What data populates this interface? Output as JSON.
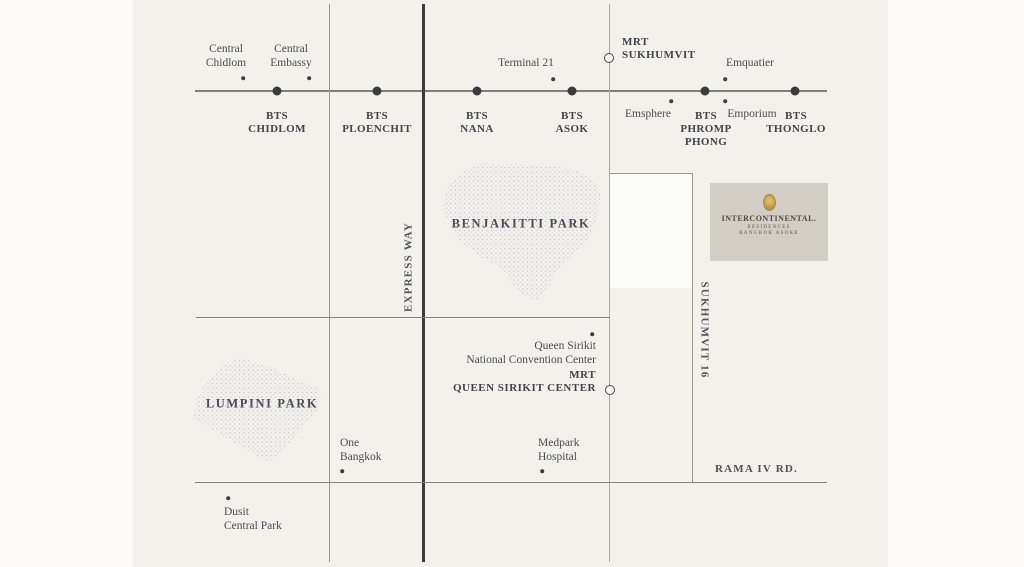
{
  "map": {
    "bts_stations": {
      "chidlom": {
        "line1": "BTS",
        "line2": "CHIDLOM"
      },
      "ploenchit": {
        "line1": "BTS",
        "line2": "PLOENCHIT"
      },
      "nana": {
        "line1": "BTS",
        "line2": "NANA"
      },
      "asok": {
        "line1": "BTS",
        "line2": "ASOK"
      },
      "phromphong": {
        "line1": "BTS",
        "line2": "PHROMP",
        "line3": "PHONG"
      },
      "thonglo": {
        "line1": "BTS",
        "line2": "THONGLO"
      }
    },
    "mrt_stations": {
      "sukhumvit": {
        "line1": "MRT",
        "line2": "SUKHUMVIT"
      },
      "queen_sirikit": {
        "line1": "MRT",
        "line2": "QUEEN SIRIKIT CENTER"
      }
    },
    "pois": {
      "central_chidlom": {
        "line1": "Central",
        "line2": "Chidlom"
      },
      "central_embassy": {
        "line1": "Central",
        "line2": "Embassy"
      },
      "terminal_21": {
        "label": "Terminal 21"
      },
      "emquatier": {
        "label": "Emquatier"
      },
      "emsphere": {
        "label": "Emsphere"
      },
      "emporium": {
        "label": "Emporium"
      },
      "qsncc": {
        "line1": "Queen Sirikit",
        "line2": "National Convention Center"
      },
      "one_bangkok": {
        "line1": "One",
        "line2": "Bangkok"
      },
      "medpark": {
        "line1": "Medpark",
        "line2": "Hospital"
      },
      "dusit_central_park": {
        "line1": "Dusit",
        "line2": "Central Park"
      }
    },
    "roads": {
      "expressway": {
        "label": "EXPRESS WAY"
      },
      "sukhumvit_16": {
        "label": "SUKHUMVIT 16"
      },
      "rama_iv": {
        "label": "RAMA IV RD."
      }
    },
    "parks": {
      "benjakitti": {
        "label": "BENJAKITTI PARK"
      },
      "lumpini": {
        "label": "LUMPINI PARK"
      }
    },
    "logo": {
      "emblem_icon": "gold-crest-oval",
      "brand": "INTERCONTINENTAL.",
      "sub1": "RESIDENCES",
      "sub2": "BANGKOK ASOKE"
    },
    "colors": {
      "page_bg": "#fbfaf7",
      "map_bg": "#f2f1ec",
      "road_line": "#8a8a84",
      "expressway_line": "#3c3c3e",
      "text": "#4a4c53",
      "park_dots": "#c3c7d2",
      "logo_card_bg": "#d2cec5",
      "logo_gold": "#c79f4e"
    }
  }
}
